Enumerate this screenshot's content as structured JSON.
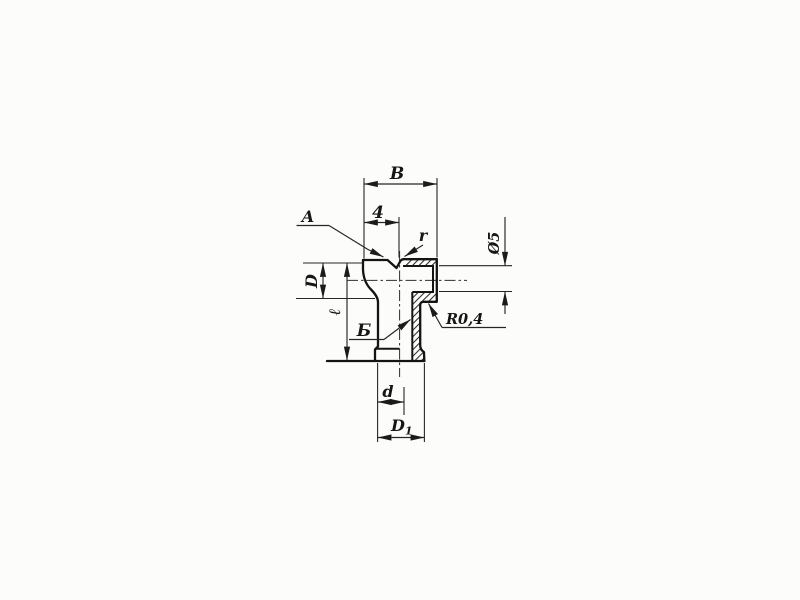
{
  "drawing": {
    "type": "technical-drawing",
    "view": "half-section of slotted hollow flanged part",
    "paper_color": "#fcfcfa",
    "ink_color": "#161616",
    "labels": {
      "head_width": "B",
      "slot_to_center": "4",
      "surface_note_a": "A",
      "fillet_small": "r",
      "bore_diameter": "Ø5",
      "head_height": "D",
      "length": "ℓ",
      "surface_note_b": "Б",
      "fillet_radius": "R0,4",
      "stem_bore": "d",
      "flange_diameter_base": "D",
      "flange_diameter_sub": "1"
    }
  }
}
